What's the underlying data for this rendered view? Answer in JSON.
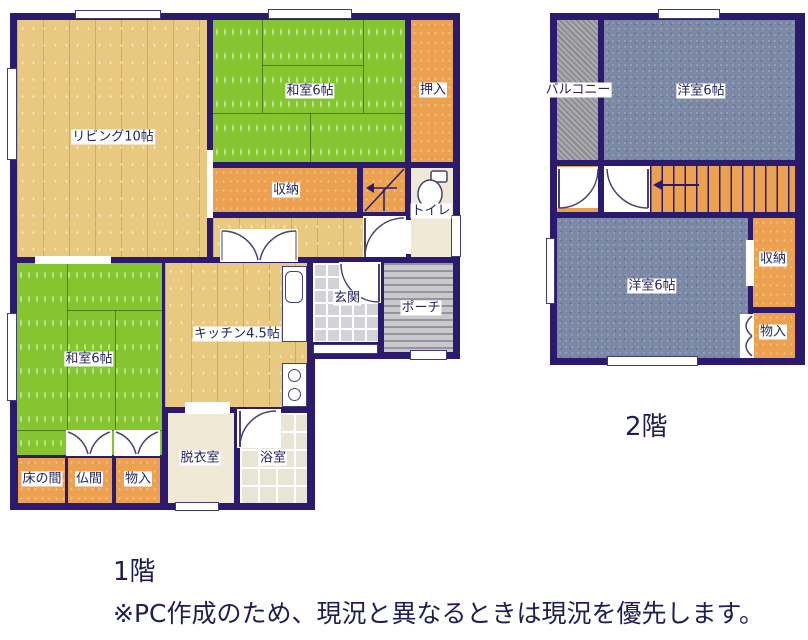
{
  "floor1": {
    "title": "1階",
    "rooms": {
      "living": "リビング10帖",
      "washitsu_top": "和室6帖",
      "oshiire": "押入",
      "shuunou": "収納",
      "toilet": "トイレ",
      "genkan": "玄関",
      "porch": "ポーチ",
      "kitchen": "キッチン4.5帖",
      "washitsu_bottom": "和室6帖",
      "tokonoma": "床の間",
      "butsuma": "仏間",
      "monoire": "物入",
      "datsuiishitsu": "脱衣室",
      "yokushitsu": "浴室"
    }
  },
  "floor2": {
    "title": "2階",
    "rooms": {
      "balcony": "バルコニー",
      "youshitsu_top": "洋室6帖",
      "youshitsu_bottom": "洋室6帖",
      "shuunou": "収納",
      "monoire": "物入"
    }
  },
  "note": "※PC作成のため、現況と異なるときは現況を優先します。",
  "colors": {
    "wall": "#2c1a6e",
    "tatami_green": "#85c52f",
    "wood_floor": "#e9c87f",
    "closet_orange": "#eca150",
    "western_blue": "#7b89a6",
    "balcony_gray": "#a9a9ad",
    "text": "#24245e"
  }
}
